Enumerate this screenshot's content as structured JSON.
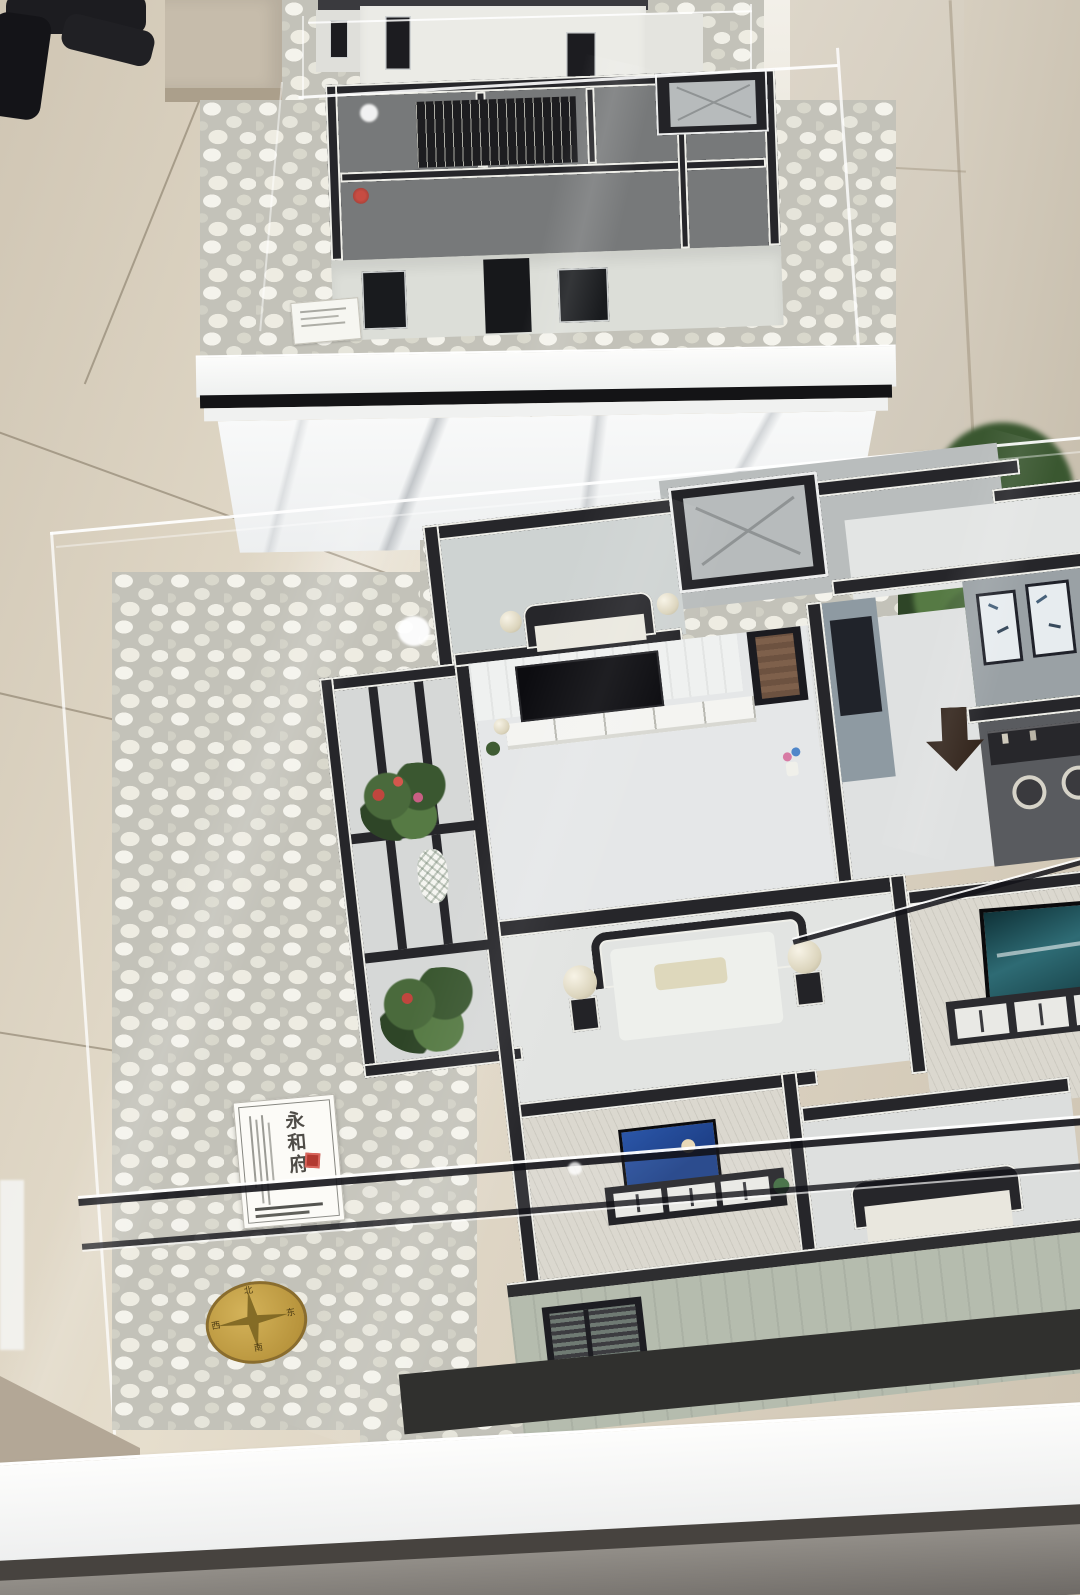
{
  "scene": {
    "description": "Real-estate showroom photo: miniature apartment scale models displayed in glass cases on white marble pedestal tables surrounded by white pebbles",
    "foreground_sign": {
      "title": "永和府"
    },
    "compass": {
      "north": "北",
      "east": "东",
      "south": "南",
      "west": "西"
    },
    "palette": {
      "floor_tile_beige": "#d9d0bf",
      "wall_beige": "#d8d1c3",
      "pebble_base": "#c3c2b9",
      "marble_white": "#f5f6f6",
      "pedestal_stripe_black": "#141416",
      "model_wall_dark": "#26262a",
      "wall_trim_white": "#efefe9",
      "front_wall_sage": "#b5bcae",
      "glass_highlight": "#ffffff",
      "compass_gold": "#c6a348",
      "seal_red": "#b23a31",
      "tv_screen_teal": "#2e6b74",
      "tv_screen_blue": "#2b56a8",
      "foliage_green": "#3a5730"
    }
  }
}
